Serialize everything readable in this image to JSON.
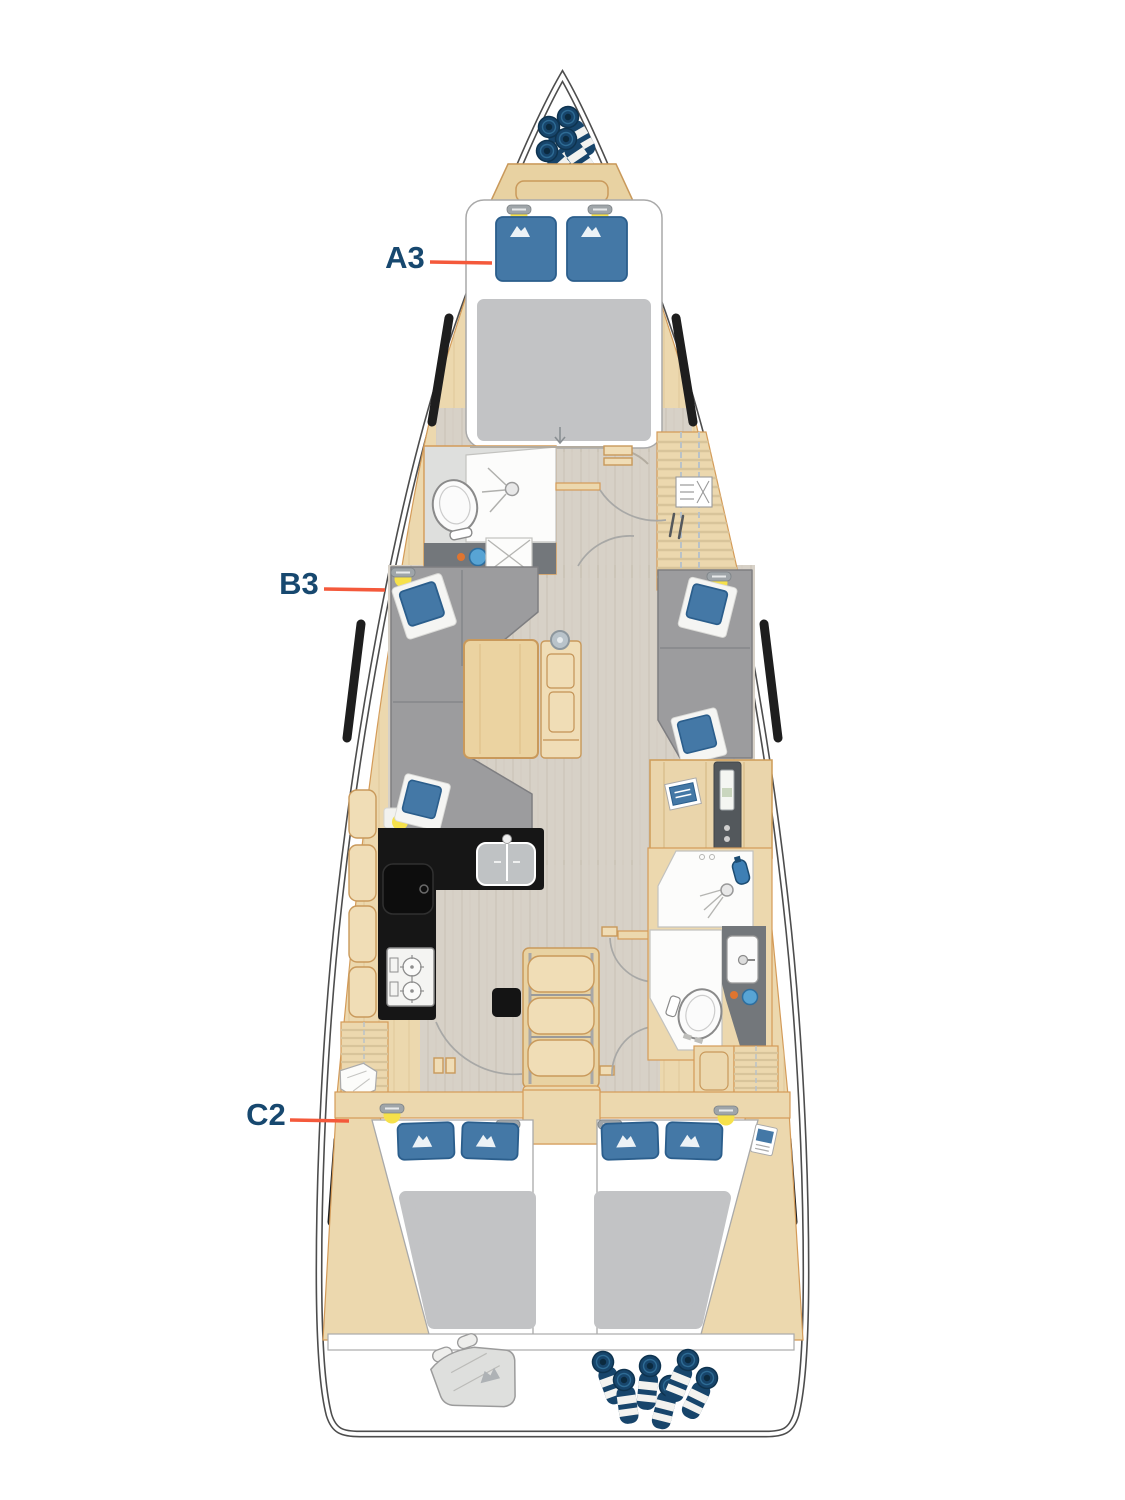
{
  "diagram_type": "yacht-interior-floor-plan",
  "cabins": [
    {
      "id": "forward-cabin",
      "label": "A3"
    },
    {
      "id": "salon",
      "label": "B3"
    },
    {
      "id": "aft-cabin-port",
      "label": "C2"
    }
  ],
  "colors": {
    "label_text": "#17486F",
    "leader_line": "#F4593B",
    "hull_outline": "#4D4D4D",
    "wood": "#ECD8AE",
    "wood_trim": "#D49B58",
    "floor": "#D7D1C7",
    "furniture_gray": "#9C9C9E",
    "cushion_blue": "#4478A6",
    "fender_navy": "#17456B",
    "galley_counter": "#161616",
    "accent_yellow": "#F6E14B",
    "sink_blue": "#58A4D4",
    "vanity_gray": "#73777B",
    "mattress_gray": "#C2C3C5"
  },
  "features": [
    "bow-fenders",
    "double-berth-forward",
    "reading-lamps",
    "forward-bathroom",
    "toilet",
    "shower",
    "sink",
    "wardrobe",
    "salon-settees",
    "salon-table",
    "mast-post",
    "galley",
    "galley-sink",
    "fridge",
    "stove",
    "nav-station",
    "instrument-panel",
    "companionway-stairs",
    "aft-bathroom",
    "aft-berth-port",
    "aft-berth-starboard",
    "hull-windows",
    "sail-bag",
    "stern-fenders"
  ]
}
